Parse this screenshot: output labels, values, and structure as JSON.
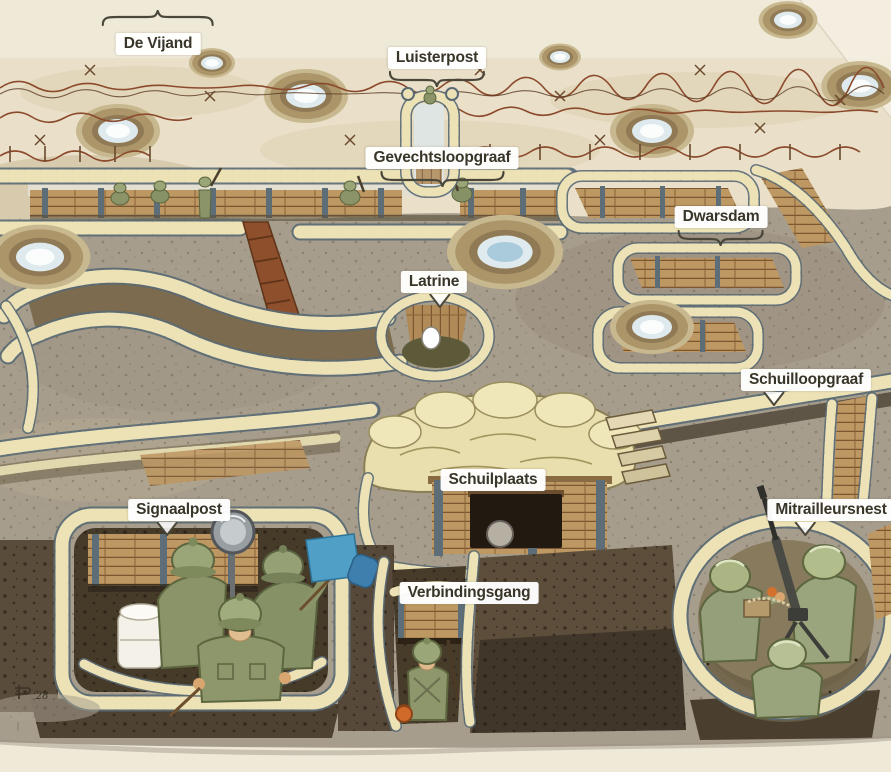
{
  "meta": {
    "canvas": {
      "width": 891,
      "height": 772
    },
    "scene_alt": "Watercolor cutaway diagram of a First World War trench system seen from above, with Dutch labels, shell craters, barbed wire, sandbag parapets, wooden revetments and soldiers."
  },
  "palette": {
    "paper": "#efe9d8",
    "no_mans_land": "#eae0ca",
    "midground": "#a69d8c",
    "dark_earth": "#4a3e2c",
    "sandbag": "#ece2b6",
    "sandbag_outline": "#5a6a74",
    "plank": "#bd9863",
    "plank_line": "#7c5631",
    "post": "#5d6e79",
    "barbed_wire": "#8b4a2b",
    "trench_floor_red": "#8d4f2c",
    "uniform_olive": "#8a9468",
    "helmet_olive": "#9aa578",
    "skin": "#d9a66f",
    "signal_flag_blue": "#4f9fc6",
    "label_text": "#393528",
    "label_background": "#ffffff",
    "pointer_stroke": "#4a463a"
  },
  "labels": [
    {
      "id": "de-vijand",
      "text": "De Vijand",
      "x": 158,
      "y": 33,
      "pointer": "brace-up",
      "pointer_width": 112,
      "pointer_dx": 0
    },
    {
      "id": "luisterpost",
      "text": "Luisterpost",
      "x": 437,
      "y": 47,
      "pointer": "brace-down",
      "pointer_width": 96,
      "pointer_dx": 0
    },
    {
      "id": "gevechtsloopgraaf",
      "text": "Gevechtsloopgraaf",
      "x": 442,
      "y": 147,
      "pointer": "brace-down",
      "pointer_width": 124,
      "pointer_dx": 0
    },
    {
      "id": "dwarsdam",
      "text": "Dwarsdam",
      "x": 721,
      "y": 206,
      "pointer": "brace-down",
      "pointer_width": 86,
      "pointer_dx": 0
    },
    {
      "id": "latrine",
      "text": "Latrine",
      "x": 434,
      "y": 271,
      "pointer": "tail-down",
      "pointer_width": 26,
      "pointer_dx": 6
    },
    {
      "id": "schuilloopgraaf",
      "text": "Schuilloopgraaf",
      "x": 806,
      "y": 369,
      "pointer": "tail-down",
      "pointer_width": 26,
      "pointer_dx": -32
    },
    {
      "id": "schuilplaats",
      "text": "Schuilplaats",
      "x": 493,
      "y": 469,
      "pointer": "none",
      "pointer_width": 0,
      "pointer_dx": 0
    },
    {
      "id": "signaalpost",
      "text": "Signaalpost",
      "x": 179,
      "y": 499,
      "pointer": "tail-down",
      "pointer_width": 26,
      "pointer_dx": -12
    },
    {
      "id": "verbindingsgang",
      "text": "Verbindingsgang",
      "x": 469,
      "y": 582,
      "pointer": "none",
      "pointer_width": 0,
      "pointer_dx": 0
    },
    {
      "id": "mitrailleursnest",
      "text": "Mitrailleursnest",
      "x": 831,
      "y": 499,
      "pointer": "tail-down",
      "pointer_width": 26,
      "pointer_dx": -26
    }
  ],
  "signature": {
    "text": "'28"
  }
}
